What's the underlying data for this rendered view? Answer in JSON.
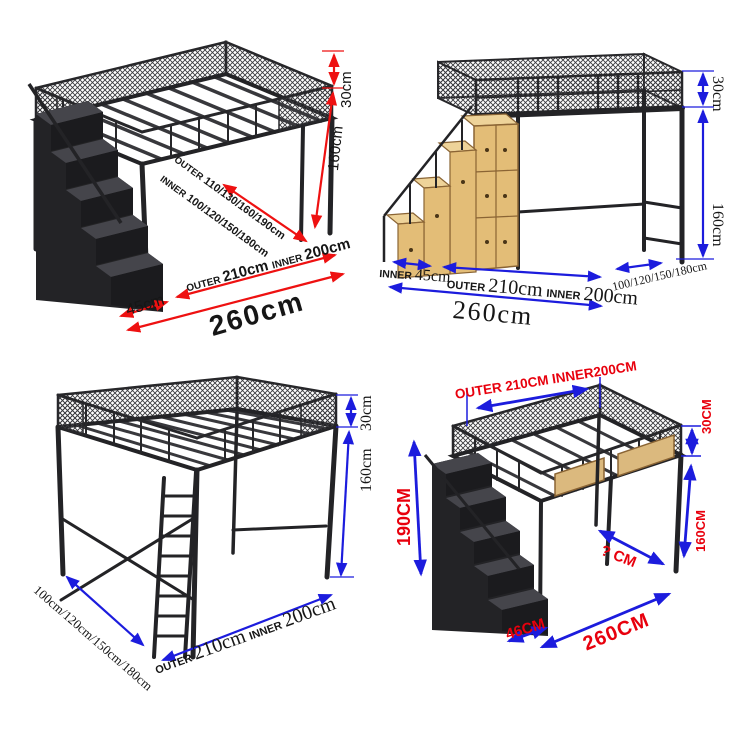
{
  "title": "Loft bed size specification diagrams (4 views)",
  "colors": {
    "background": "#ffffff",
    "frame_black": "#27272a",
    "wood": "#e3bd77",
    "red_arrow": "#ee1111",
    "blue_arrow": "#1c1cdd",
    "red_label": "#e8000d",
    "black_label": "#161616"
  },
  "panel_top_left": {
    "rail_height": "30cm",
    "clearance_height": "160cm",
    "width_outer_label": "OUTER",
    "width_outer_values": "110/130/160/190cm",
    "width_inner_label": "INNER",
    "width_inner_values": "100/120/150/180cm",
    "stair_depth": "45cm",
    "length_outer_label": "OUTER",
    "length_outer_value": "210cm",
    "length_inner_label": "INNER",
    "length_inner_value": "200cm",
    "total_length": "260cm"
  },
  "panel_top_right": {
    "rail_height": "30cm",
    "clearance_height": "160cm",
    "stair_label": "INNER",
    "stair_depth": "45cm",
    "length_outer_label": "OUTER",
    "length_outer_value": "210cm",
    "length_inner_label": "INNER",
    "length_inner_value": "200cm",
    "width_values": "100/120/150/180cm",
    "total_length": "260cm"
  },
  "panel_bottom_left": {
    "rail_height": "30cm",
    "clearance_height": "160cm",
    "width_values": "100cm/120cm/150cm/180cm",
    "length_outer_label": "OUTER",
    "length_outer_value": "210cm",
    "length_inner_label": "INNER",
    "length_inner_value": "200cm"
  },
  "panel_bottom_right": {
    "length_label": "OUTER 210CM INNER200CM",
    "rail_height": "30CM",
    "clearance_height": "160CM",
    "total_height": "190CM",
    "floor_depth": "? CM",
    "stair_depth": "46CM",
    "total_length": "260CM"
  }
}
